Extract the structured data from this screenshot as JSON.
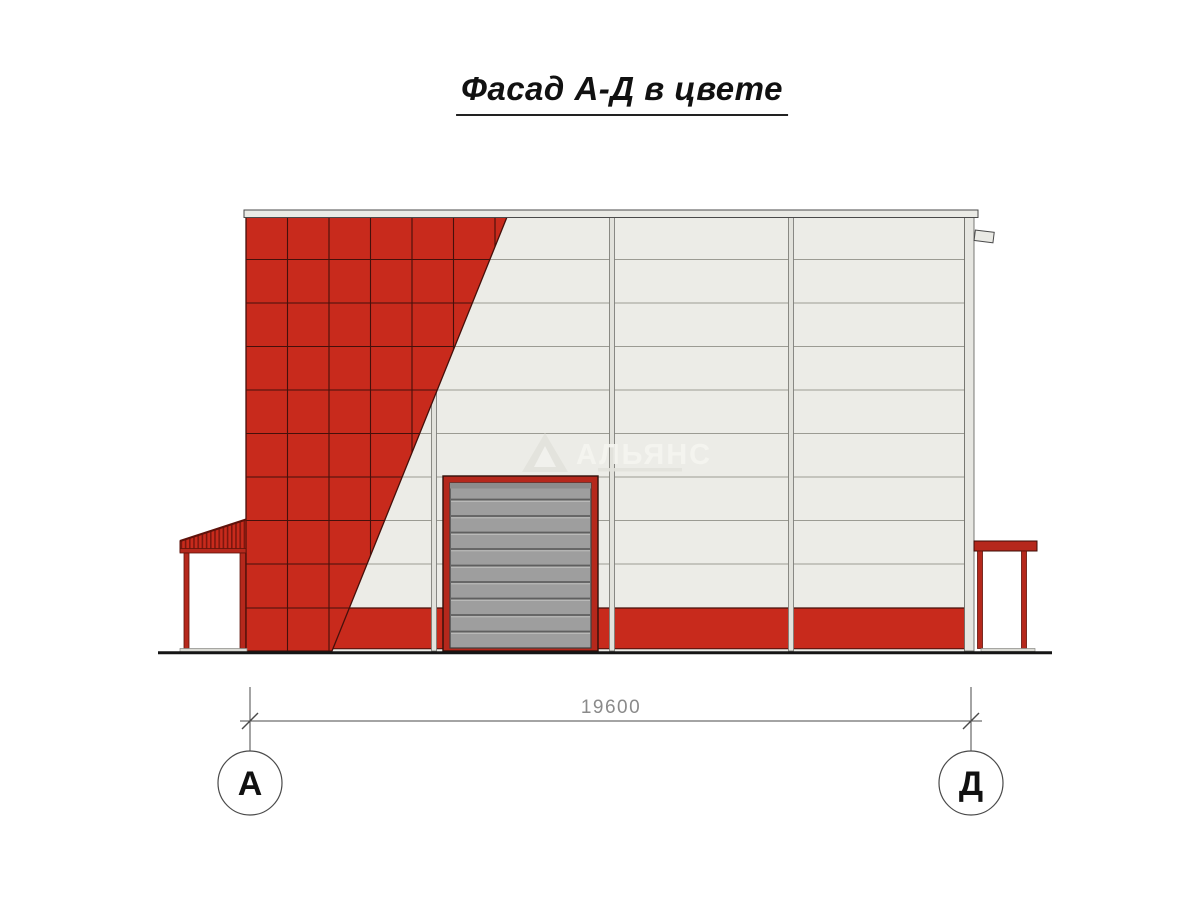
{
  "title": {
    "text": "Фасад А-Д в цвете"
  },
  "drawing": {
    "dimension": {
      "value": "19600"
    },
    "axes": {
      "left": "А",
      "right": "Д"
    },
    "watermark": {
      "text": "АЛЬЯНС"
    },
    "colors": {
      "facade_red": "#c82a1c",
      "tile_joint": "#45100b",
      "panel_white": "#ECECE7",
      "panel_joint": "#9B9B93",
      "cap_gray": "#EAEAE5",
      "door_gray": "#9E9E9E",
      "frame_red": "#B5281C",
      "line_dark": "#4A4A4A",
      "dim_text_gray": "#8A8A8A",
      "ground_black": "#151515"
    }
  }
}
